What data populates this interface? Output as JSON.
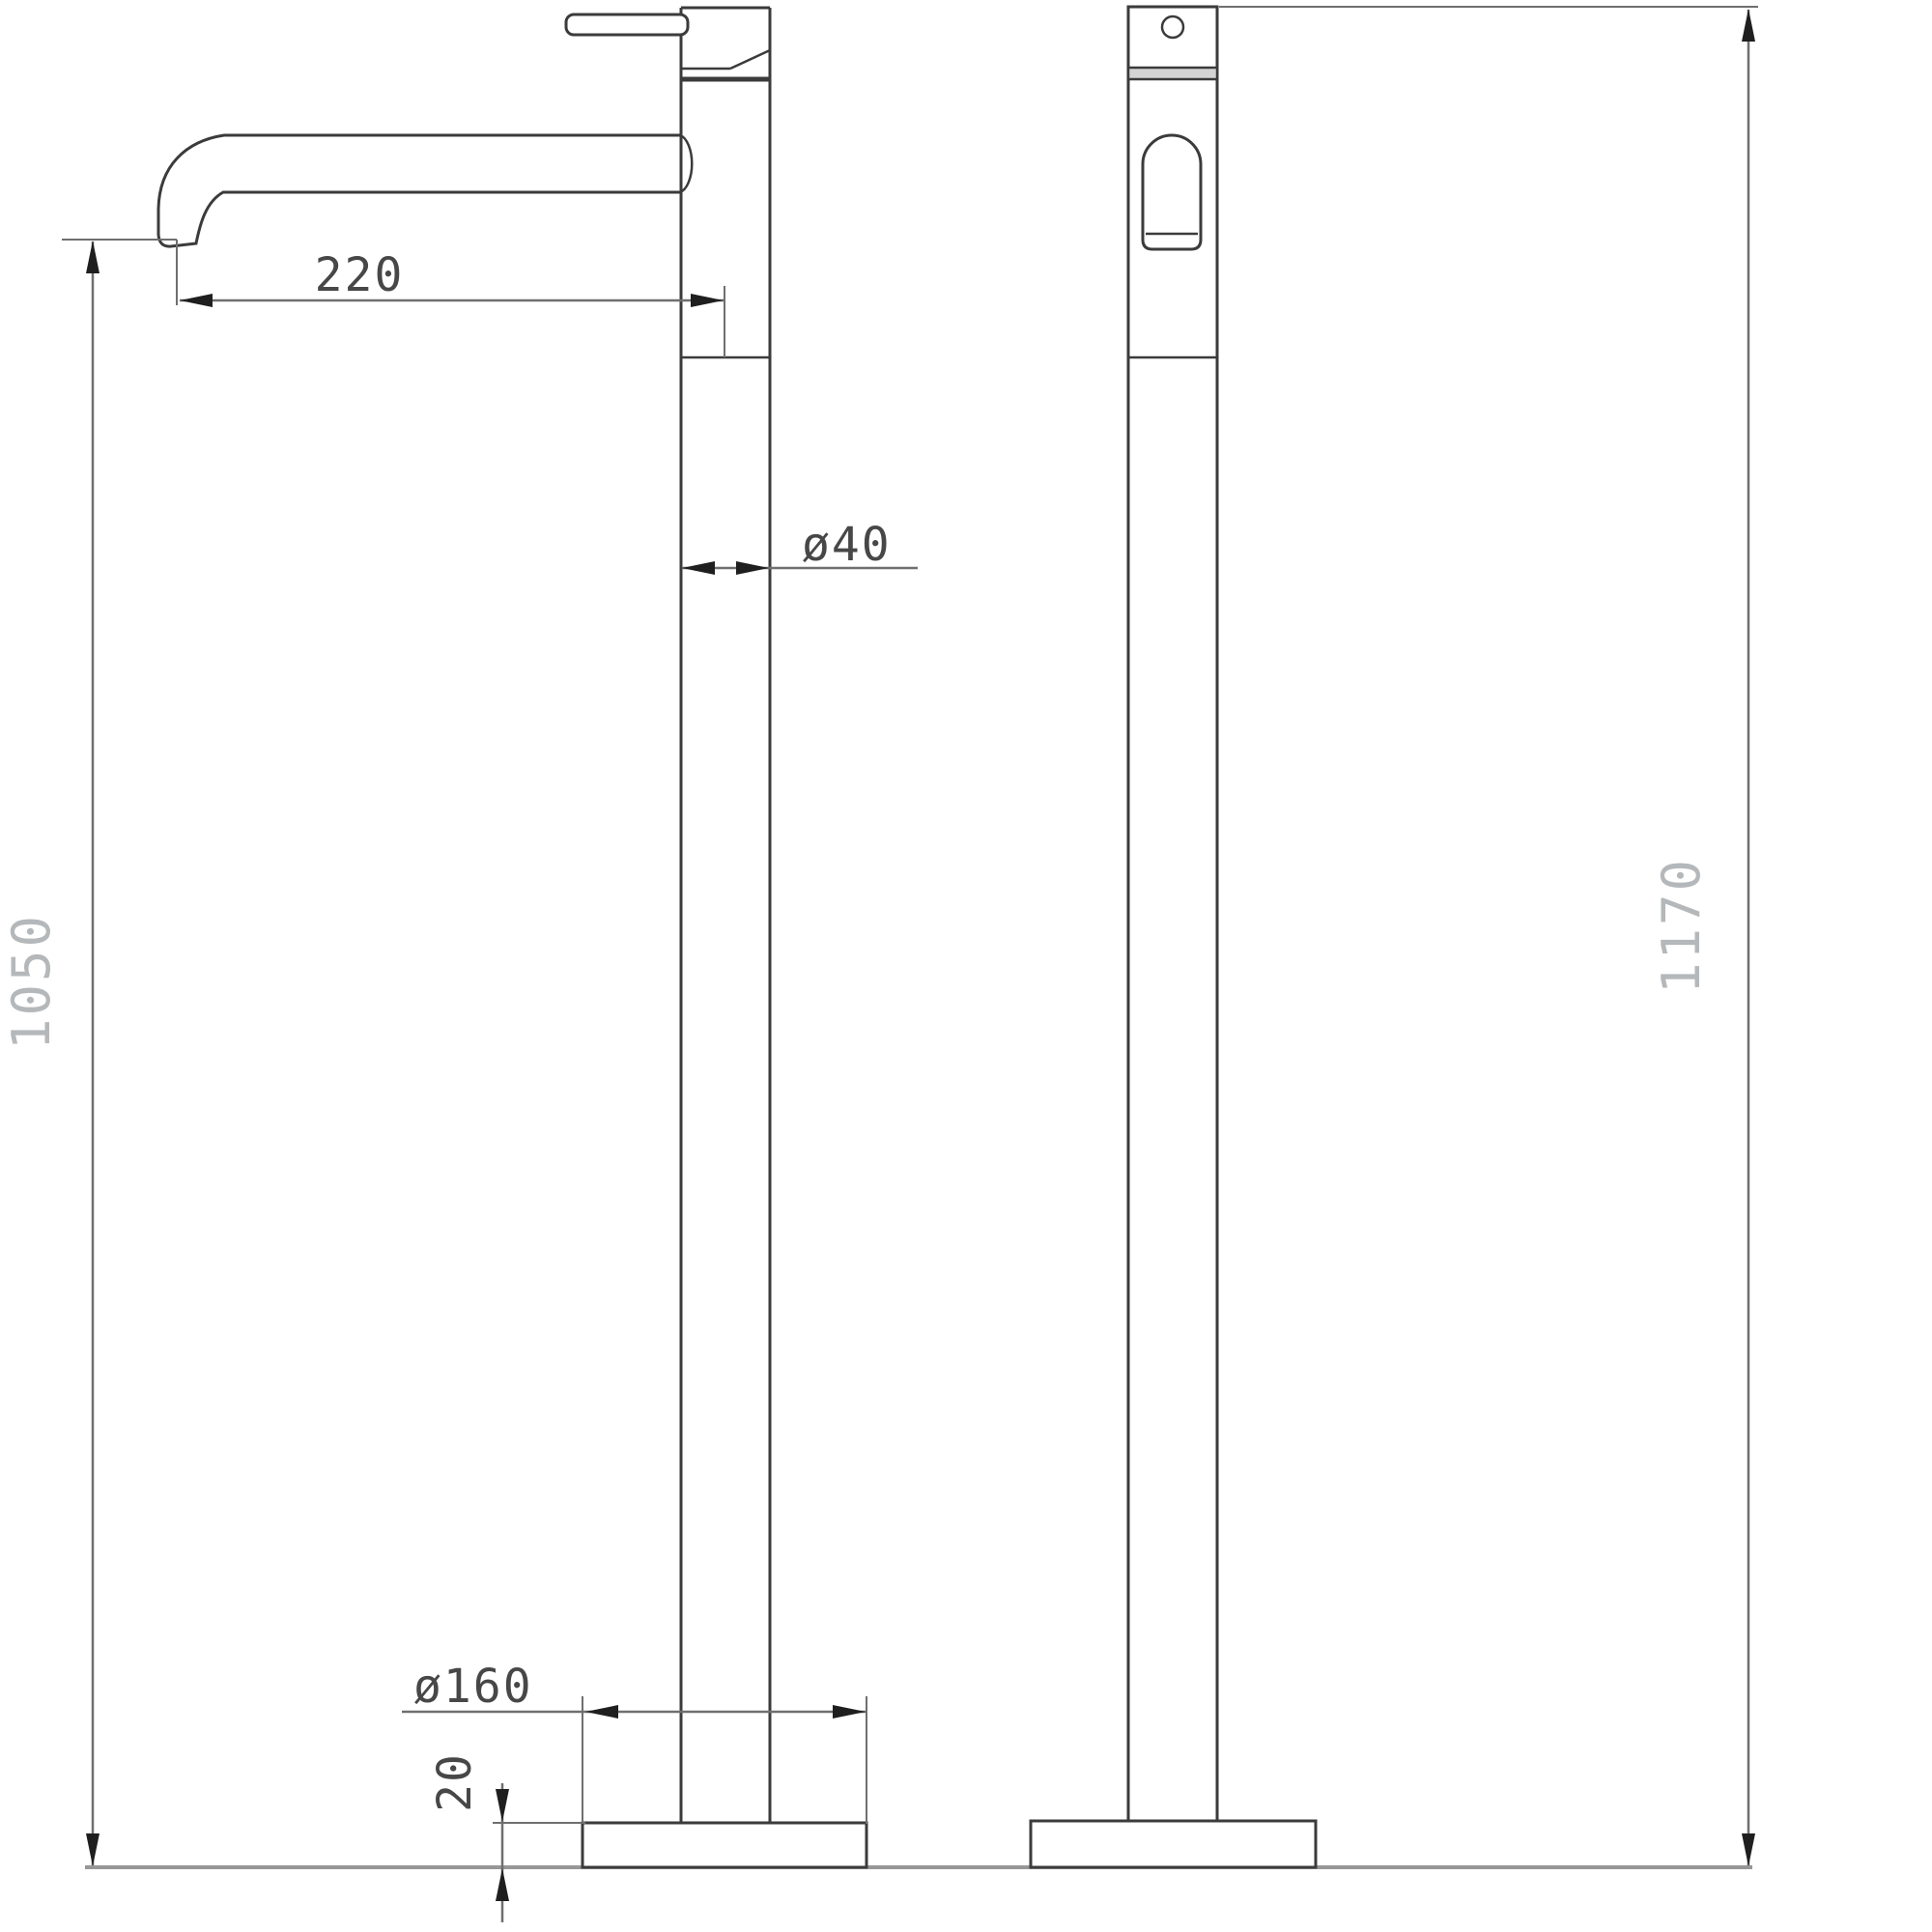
{
  "drawing": {
    "kind": "technical dimension drawing, two orthographic views of a freestanding tall basin mixer tap",
    "views": {
      "front": "front view with spout and lever",
      "side": "side profile view"
    }
  },
  "dimensions": {
    "spout_reach": {
      "label": "220"
    },
    "column_diameter": {
      "label": "ø40"
    },
    "spout_height": {
      "label": "1050"
    },
    "base_diameter": {
      "label": "ø160"
    },
    "base_height": {
      "label": "20"
    },
    "total_height": {
      "label": "1170"
    }
  },
  "colors": {
    "outline": "#3b3b3b",
    "dim_line": "#6f6f6f",
    "arrow": "#1f1f1f",
    "dim_text_dark": "#474747",
    "dim_text_light": "#b5b8ba",
    "floor_line": "#979797",
    "background": "#ffffff"
  }
}
